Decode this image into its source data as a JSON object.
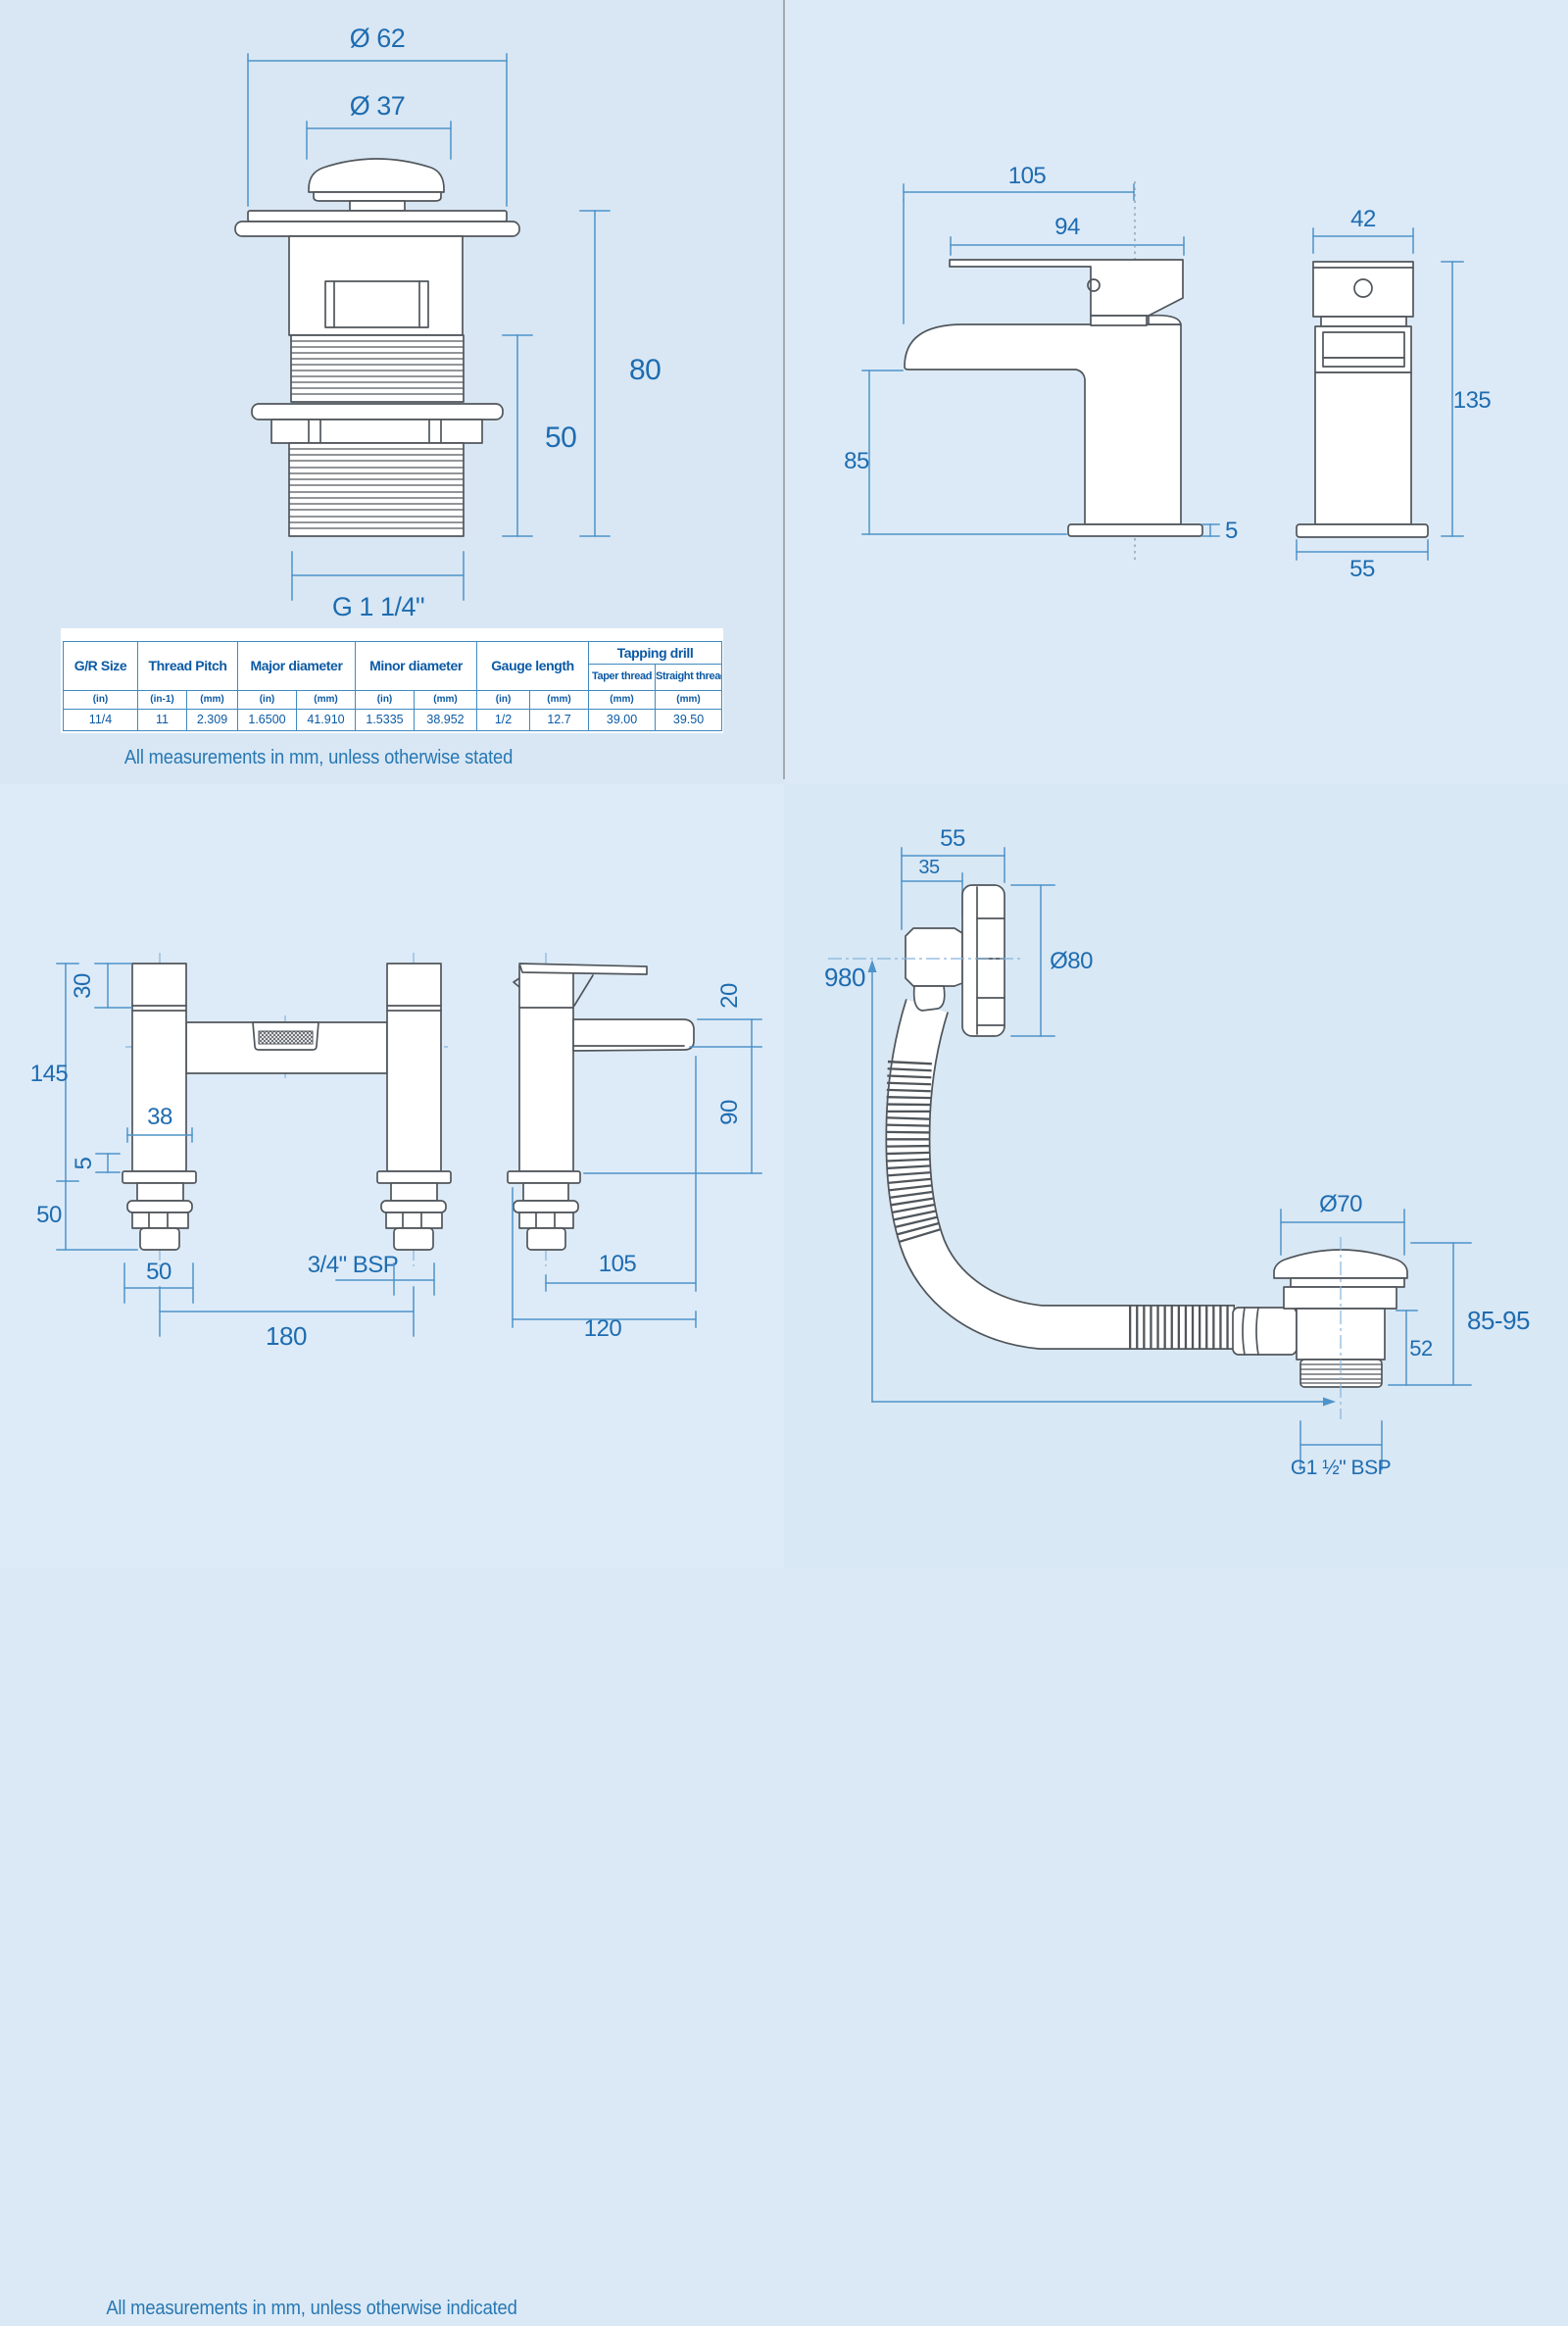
{
  "colors": {
    "background": "#dbe9f6",
    "dimension_text": "#1e6cb0",
    "dimension_line": "#4e93c9",
    "outline": "#50565b",
    "table_border": "#3f8ac0",
    "table_text": "#0b5aa5"
  },
  "waste": {
    "dims": {
      "outer_diameter": "Ø 62",
      "cap_diameter": "Ø 37",
      "total_height": "80",
      "thread_length": "50",
      "thread_size": "G 1 1/4\""
    },
    "table": {
      "headers": {
        "size": "G/R Size",
        "pitch": "Thread Pitch",
        "major": "Major diameter",
        "minor": "Minor diameter",
        "gauge": "Gauge length",
        "tapping": "Tapping drill",
        "taper": "Taper thread",
        "straight": "Straight thread"
      },
      "units": [
        "(in)",
        "(in-1)",
        "(mm)",
        "(in)",
        "(mm)",
        "(in)",
        "(mm)",
        "(in)",
        "(mm)",
        "(mm)",
        "(mm)"
      ],
      "values": [
        "11/4",
        "11",
        "2.309",
        "1.6500",
        "41.910",
        "1.5335",
        "38.952",
        "1/2",
        "12.7",
        "39.00",
        "39.50"
      ]
    },
    "caption": "All measurements in mm, unless otherwise stated"
  },
  "basin_mixer": {
    "dims": {
      "overall_depth": "105",
      "spout_reach": "94",
      "spout_height": "85",
      "base_plate": "5",
      "body_width": "42",
      "overall_height": "135",
      "base_width": "55"
    },
    "caption": "All measurements in mm, unless otherwise indicated"
  },
  "bath_filler": {
    "dims": {
      "head_height": "30",
      "overall_height": "145",
      "body_width": "38",
      "flange": "5",
      "shank_length": "50",
      "base_width": "50",
      "hole_centres": "180",
      "connection": "3/4\" BSP",
      "spout_mouth": "20",
      "spout_clearance": "90",
      "spout_reach": "105",
      "overall_depth": "120"
    },
    "caption": "All measurements in mm, unless otherwise indicated"
  },
  "bath_overflow": {
    "dims": {
      "overflow_depth": "55",
      "body_depth": "35",
      "face_diameter": "Ø80",
      "hose_length": "980",
      "cap_diameter": "Ø70",
      "height_range": "85-95",
      "body_height": "52",
      "connection": "G1 ½\" BSP"
    },
    "caption": "All measurements in mm, unless otherwise indicated"
  }
}
